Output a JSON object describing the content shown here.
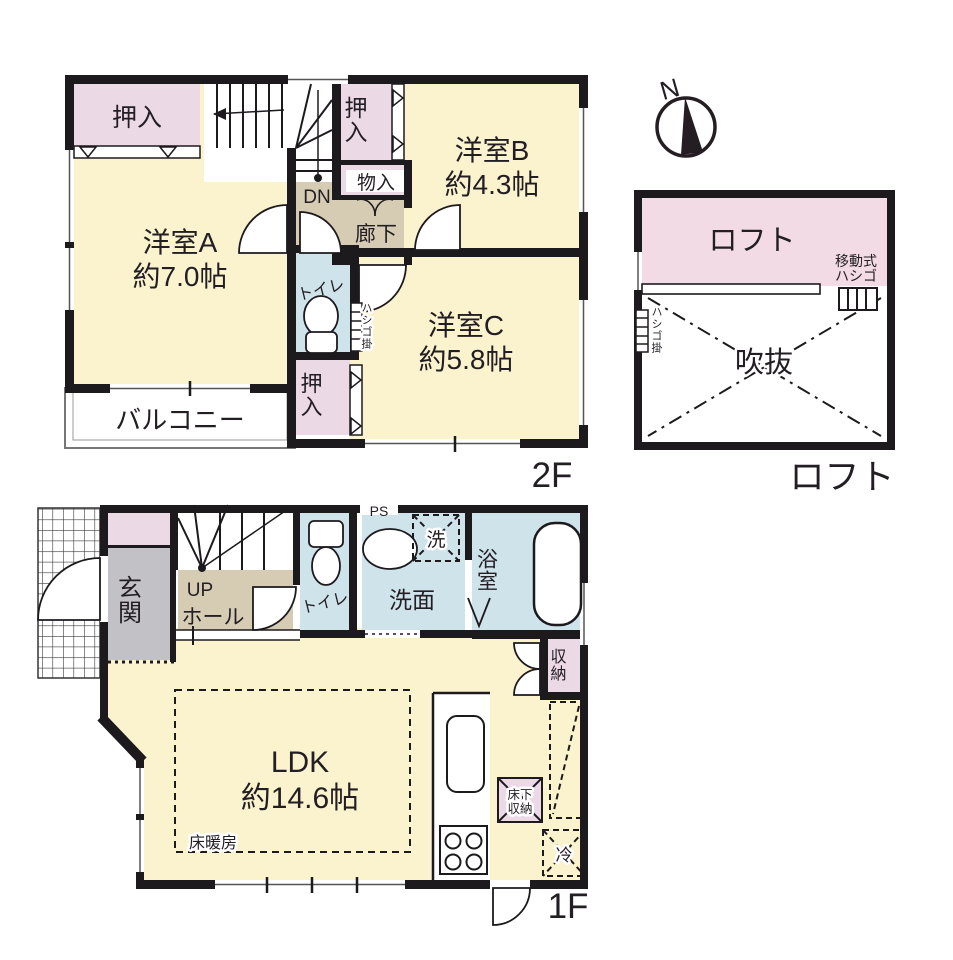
{
  "colors": {
    "wall": "#1d1a1e",
    "room_cream": "#fbf2ce",
    "closet_pink": "#ecd9e6",
    "loft_pink": "#f2dbe5",
    "wet_blue": "#cfe3ea",
    "hall_tan": "#d6ccb4",
    "entrance_gray": "#c2c1c6"
  },
  "f2": {
    "floor_label": "2F",
    "room_a_name": "洋室A",
    "room_a_size": "約7.0帖",
    "room_b_name": "洋室B",
    "room_b_size": "約4.3帖",
    "room_c_name": "洋室C",
    "room_c_size": "約5.8帖",
    "closet_top_left": "押入",
    "closet_top_mid": "押入",
    "closet_bottom": "押入",
    "storage_small": "物入",
    "corridor": "廊下",
    "stairs_dn": "DN",
    "toilet": "トイレ",
    "ladder_hook": "ハシゴ掛",
    "balcony": "バルコニー"
  },
  "loft": {
    "floor_label": "ロフト",
    "compass_north": "N",
    "loft_area": "ロフト",
    "movable_ladder_line1": "移動式",
    "movable_ladder_line2": "ハシゴ",
    "ladder_hook": "ハシゴ掛",
    "void": "吹抜"
  },
  "f1": {
    "floor_label": "1F",
    "entrance": "玄関",
    "stairs_up": "UP",
    "hall": "ホール",
    "toilet": "トイレ",
    "pipe_space": "PS",
    "washroom": "洗面",
    "washer": "洗",
    "bathroom": "浴室",
    "storage": "収納",
    "ldk_name": "LDK",
    "ldk_size": "約14.6帖",
    "floor_heating": "床暖房",
    "underfloor_line1": "床下",
    "underfloor_line2": "収納",
    "fridge": "冷"
  }
}
